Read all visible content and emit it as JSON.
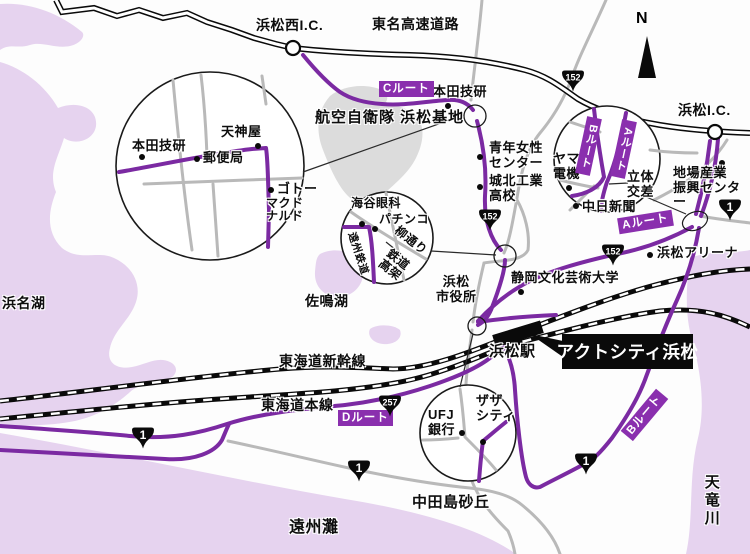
{
  "colors": {
    "route_purple": "#7b2aa2",
    "route_box_purple": "#8a2fae",
    "water_lavender": "#e8d7f1",
    "road_gray": "#b9b9b9",
    "base_gray": "#dcdcdc"
  },
  "compass": {
    "north": "N"
  },
  "expressway": {
    "name": "東名高速道路",
    "ic_west": "浜松西I.C.",
    "ic_east": "浜松I.C."
  },
  "routes": {
    "a": "Aルート",
    "b": "Bルート",
    "c": "Cルート",
    "d": "Dルート"
  },
  "shields": {
    "r152": "152",
    "r1": "1",
    "r257": "257"
  },
  "railways": {
    "shinkansen": "東海道新幹線",
    "main_line": "東海道本線",
    "station": "浜松駅"
  },
  "destination": {
    "name": "アクトシティ浜松"
  },
  "geography": {
    "lake_hamana": "浜名湖",
    "lake_sanaru": "佐鳴湖",
    "enshu_nada": "遠州灘",
    "tenryu_river": "天竜川",
    "nakatajima_dunes": "中田島砂丘",
    "airbase": "航空自衛隊 浜松基地"
  },
  "landmarks": {
    "honda": "本田技研",
    "seinen_josei_center": "青年女性\nセンター",
    "johoku_kogyo": "城北工業\n高校",
    "yamada_denki": "ヤマダ\n電機",
    "chunichi_shimbun": "中日新聞",
    "rittai_kosa": "立体\n交差",
    "jiba_sangyo": "地場産業\n振興センター",
    "arena": "浜松アリーナ",
    "geijutsu_univ": "静岡文化芸術大学",
    "city_hall": "浜松\n市役所"
  },
  "inset_honda": {
    "honda": "本田技研",
    "tenjinya": "天神屋",
    "post_office": "郵便局",
    "goto": "ゴトー",
    "mcdonalds": "マクド\nナルド"
  },
  "inset_yanagi": {
    "kaiya_ganka": "海谷眼科",
    "pachinko": "パチンコ",
    "yanagi_dori": "柳通り",
    "enshu_railway": "遠州鉄道",
    "rail_overpass": "鉄道\n高架"
  },
  "inset_zaza": {
    "ufj_bank": "UFJ\n銀行",
    "zaza_city": "ザザ\nシティ"
  }
}
